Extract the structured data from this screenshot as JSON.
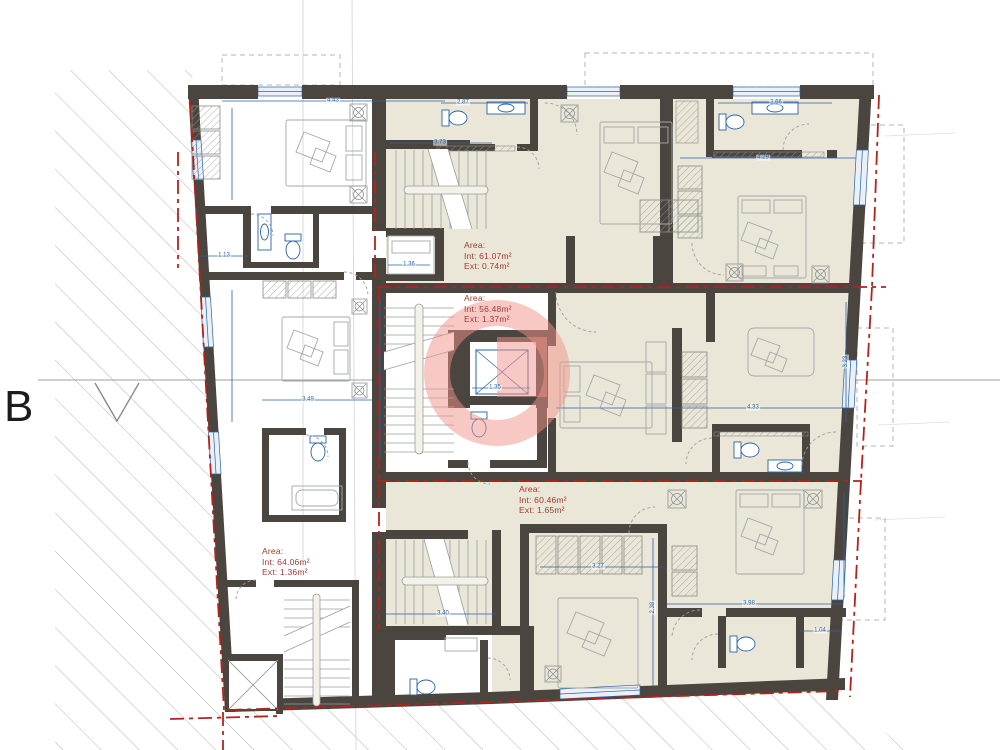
{
  "section_marker": {
    "label": "B"
  },
  "area_labels": [
    {
      "title": "Area:",
      "int": "Int: 61.07m²",
      "ext": "Ext: 0.74m²"
    },
    {
      "title": "Area:",
      "int": "Int: 56.48m²",
      "ext": "Ext: 1.37m²"
    },
    {
      "title": "Area:",
      "int": "Int: 60.46m²",
      "ext": "Ext: 1.65m²"
    },
    {
      "title": "Area:",
      "int": "Int: 64.06m²",
      "ext": "Ext: 1.36m²"
    }
  ],
  "dimensions": [
    {
      "t": "4.43",
      "x": 333,
      "y": 101
    },
    {
      "t": "1.13",
      "x": 224,
      "y": 256
    },
    {
      "t": "3.49",
      "x": 308,
      "y": 400
    },
    {
      "t": "3.73",
      "x": 440,
      "y": 143
    },
    {
      "t": "1.36",
      "x": 409,
      "y": 265
    },
    {
      "t": "2.87",
      "x": 463,
      "y": 103
    },
    {
      "t": "2.66",
      "x": 776,
      "y": 103
    },
    {
      "t": "4.29",
      "x": 763,
      "y": 158
    },
    {
      "t": "3.23",
      "x": 846,
      "y": 362,
      "r": -90
    },
    {
      "t": "4.33",
      "x": 753,
      "y": 408
    },
    {
      "t": "1.35",
      "x": 495,
      "y": 388
    },
    {
      "t": "3.27",
      "x": 598,
      "y": 567
    },
    {
      "t": "2.38",
      "x": 653,
      "y": 608,
      "r": -90
    },
    {
      "t": "3.40",
      "x": 443,
      "y": 614
    },
    {
      "t": "3.98",
      "x": 749,
      "y": 604
    },
    {
      "t": "1.04",
      "x": 820,
      "y": 631
    }
  ],
  "colors": {
    "wall": "#4a453e",
    "room_fill": "#eae6d8",
    "dimension_blue": "#2a63a8",
    "boundary_red": "#b0241c",
    "area_text": "#9e3a2c",
    "highlight_pink": "#f2948a"
  }
}
